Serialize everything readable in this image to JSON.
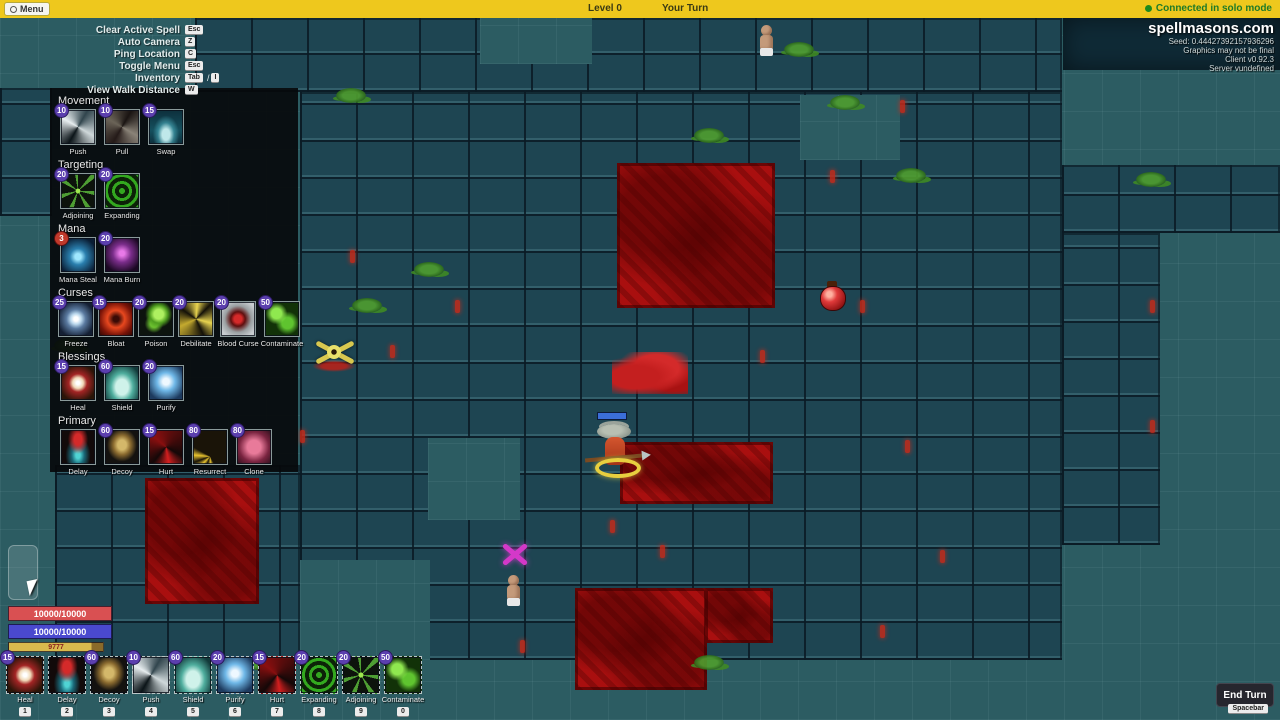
{
  "top_bar": {
    "menu_label": "Menu",
    "level_label": "Level 0",
    "turn_label": "Your Turn",
    "connection_status": "Connected in solo mode",
    "bar_color": "#eec81d",
    "status_color": "#1e7a28"
  },
  "info_panel": {
    "site": "spellmasons.com",
    "lines": [
      "Seed: 0.44427392157936296",
      "Graphics may not be final",
      "Client v0.92.3",
      "Server vundefined"
    ]
  },
  "keybinds": [
    {
      "label": "Clear Active Spell",
      "keys": [
        "Esc"
      ]
    },
    {
      "label": "Auto Camera",
      "keys": [
        "Z"
      ]
    },
    {
      "label": "Ping Location",
      "keys": [
        "C"
      ]
    },
    {
      "label": "Toggle Menu",
      "keys": [
        "Esc"
      ]
    },
    {
      "label": "Inventory",
      "keys": [
        "Tab",
        "I"
      ]
    },
    {
      "label": "View Walk Distance",
      "keys": [
        "W"
      ]
    }
  ],
  "spellbook": {
    "sections": [
      {
        "title": "Movement",
        "spells": [
          {
            "name": "Push",
            "cost": "10",
            "icon": "push"
          },
          {
            "name": "Pull",
            "cost": "10",
            "icon": "pull"
          },
          {
            "name": "Swap",
            "cost": "15",
            "icon": "swap"
          }
        ]
      },
      {
        "title": "Targeting",
        "spells": [
          {
            "name": "Adjoining",
            "cost": "20",
            "icon": "adjoining"
          },
          {
            "name": "Expanding",
            "cost": "20",
            "icon": "expanding"
          }
        ]
      },
      {
        "title": "Mana",
        "spells": [
          {
            "name": "Mana Steal",
            "cost": "3",
            "icon": "mana-steal",
            "badge": "red"
          },
          {
            "name": "Mana Burn",
            "cost": "20",
            "icon": "mana-burn"
          }
        ]
      },
      {
        "title": "Curses",
        "spells": [
          {
            "name": "Freeze",
            "cost": "25",
            "icon": "freeze"
          },
          {
            "name": "Bloat",
            "cost": "15",
            "icon": "bloat"
          },
          {
            "name": "Poison",
            "cost": "20",
            "icon": "poison"
          },
          {
            "name": "Debilitate",
            "cost": "20",
            "icon": "debilitate"
          },
          {
            "name": "Blood Curse",
            "cost": "20",
            "icon": "blood-curse"
          },
          {
            "name": "Contaminate",
            "cost": "50",
            "icon": "contaminate"
          }
        ]
      },
      {
        "title": "Blessings",
        "spells": [
          {
            "name": "Heal",
            "cost": "15",
            "icon": "heal"
          },
          {
            "name": "Shield",
            "cost": "60",
            "icon": "shield"
          },
          {
            "name": "Purify",
            "cost": "20",
            "icon": "purify"
          }
        ]
      },
      {
        "title": "Primary",
        "spells": [
          {
            "name": "Delay",
            "cost": "",
            "icon": "delay"
          },
          {
            "name": "Decoy",
            "cost": "60",
            "icon": "decoy"
          },
          {
            "name": "Hurt",
            "cost": "15",
            "icon": "hurt"
          },
          {
            "name": "Resurrect",
            "cost": "80",
            "icon": "resurrect"
          },
          {
            "name": "Clone",
            "cost": "80",
            "icon": "clone"
          }
        ]
      }
    ]
  },
  "player_stats": {
    "health": {
      "text": "10000/10000",
      "color": "#d95052"
    },
    "mana": {
      "text": "10000/10000",
      "color": "#4a49cf"
    },
    "stamina": {
      "text": "9777",
      "color": "#d9b94d"
    }
  },
  "toolbar": {
    "slots": [
      {
        "name": "Heal",
        "cost": "15",
        "hotkey": "1",
        "icon": "heal"
      },
      {
        "name": "Delay",
        "cost": "",
        "hotkey": "2",
        "icon": "delay"
      },
      {
        "name": "Decoy",
        "cost": "60",
        "hotkey": "3",
        "icon": "decoy"
      },
      {
        "name": "Push",
        "cost": "10",
        "hotkey": "4",
        "icon": "push"
      },
      {
        "name": "Shield",
        "cost": "60",
        "hotkey": "5",
        "icon": "shield"
      },
      {
        "name": "Purify",
        "cost": "20",
        "hotkey": "6",
        "icon": "purify"
      },
      {
        "name": "Hurt",
        "cost": "15",
        "hotkey": "7",
        "icon": "hurt"
      },
      {
        "name": "Expanding",
        "cost": "20",
        "hotkey": "8",
        "icon": "expanding"
      },
      {
        "name": "Adjoining",
        "cost": "20",
        "hotkey": "9",
        "icon": "adjoining"
      },
      {
        "name": "Contaminate",
        "cost": "50",
        "hotkey": "0",
        "icon": "contaminate"
      }
    ]
  },
  "end_turn": {
    "label": "End Turn",
    "hotkey": "Spacebar"
  },
  "map": {
    "floor_color": "#2c5c62",
    "stone_color": "#1e4552",
    "pool_color": "#a90f0f",
    "stone_regions": [
      {
        "x": 195,
        "y": 0,
        "w": 867,
        "h": 74
      },
      {
        "x": 0,
        "y": 70,
        "w": 52,
        "h": 128
      },
      {
        "x": 300,
        "y": 74,
        "w": 762,
        "h": 568
      },
      {
        "x": 55,
        "y": 447,
        "w": 245,
        "h": 195
      },
      {
        "x": 1062,
        "y": 147,
        "w": 218,
        "h": 68
      },
      {
        "x": 1062,
        "y": 215,
        "w": 98,
        "h": 312
      }
    ],
    "walls": [
      {
        "x": 1063,
        "y": 0,
        "w": 217,
        "h": 52
      }
    ],
    "floor_holes": [
      {
        "x": 428,
        "y": 420,
        "w": 92,
        "h": 82
      },
      {
        "x": 480,
        "y": 0,
        "w": 112,
        "h": 46
      },
      {
        "x": 800,
        "y": 77,
        "w": 100,
        "h": 65
      },
      {
        "x": 300,
        "y": 542,
        "w": 130,
        "h": 100
      }
    ],
    "pools": [
      {
        "x": 617,
        "y": 145,
        "w": 158,
        "h": 145
      },
      {
        "x": 145,
        "y": 460,
        "w": 114,
        "h": 126
      },
      {
        "x": 620,
        "y": 424,
        "w": 153,
        "h": 62
      },
      {
        "x": 575,
        "y": 570,
        "w": 132,
        "h": 102
      },
      {
        "x": 705,
        "y": 570,
        "w": 68,
        "h": 55
      }
    ],
    "moss": [
      {
        "x": 336,
        "y": 70
      },
      {
        "x": 784,
        "y": 24
      },
      {
        "x": 896,
        "y": 150
      },
      {
        "x": 1136,
        "y": 154
      },
      {
        "x": 414,
        "y": 244
      },
      {
        "x": 352,
        "y": 280
      },
      {
        "x": 694,
        "y": 110
      },
      {
        "x": 54,
        "y": 320
      },
      {
        "x": 244,
        "y": 637
      },
      {
        "x": 386,
        "y": 642
      },
      {
        "x": 694,
        "y": 637
      },
      {
        "x": 830,
        "y": 77
      }
    ],
    "cracks": [
      {
        "x": 350,
        "y": 232
      },
      {
        "x": 390,
        "y": 327
      },
      {
        "x": 455,
        "y": 282
      },
      {
        "x": 300,
        "y": 412
      },
      {
        "x": 610,
        "y": 502
      },
      {
        "x": 660,
        "y": 527
      },
      {
        "x": 760,
        "y": 332
      },
      {
        "x": 860,
        "y": 282
      },
      {
        "x": 905,
        "y": 422
      },
      {
        "x": 940,
        "y": 532
      },
      {
        "x": 1150,
        "y": 282
      },
      {
        "x": 1150,
        "y": 402
      },
      {
        "x": 880,
        "y": 607
      },
      {
        "x": 520,
        "y": 622
      },
      {
        "x": 830,
        "y": 152
      },
      {
        "x": 900,
        "y": 82
      }
    ],
    "entities": [
      {
        "kind": "villager",
        "name": "villager-north",
        "x": 758,
        "y": 7
      },
      {
        "kind": "potion",
        "name": "red-potion",
        "x": 819,
        "y": 263
      },
      {
        "kind": "yellow-creature",
        "name": "yellow-creature",
        "x": 308,
        "y": 318
      },
      {
        "kind": "corpse",
        "name": "corpse-splatter",
        "x": 612,
        "y": 334
      },
      {
        "kind": "player",
        "name": "player-mage",
        "x": 583,
        "y": 394
      },
      {
        "kind": "purple-marker",
        "name": "purple-marker",
        "x": 498,
        "y": 520
      },
      {
        "kind": "villager",
        "name": "villager-south",
        "x": 505,
        "y": 557
      }
    ],
    "overlay": {
      "ghost_card": {
        "x": 8,
        "y": 527
      },
      "cursor": {
        "x": 28,
        "y": 562
      }
    }
  }
}
